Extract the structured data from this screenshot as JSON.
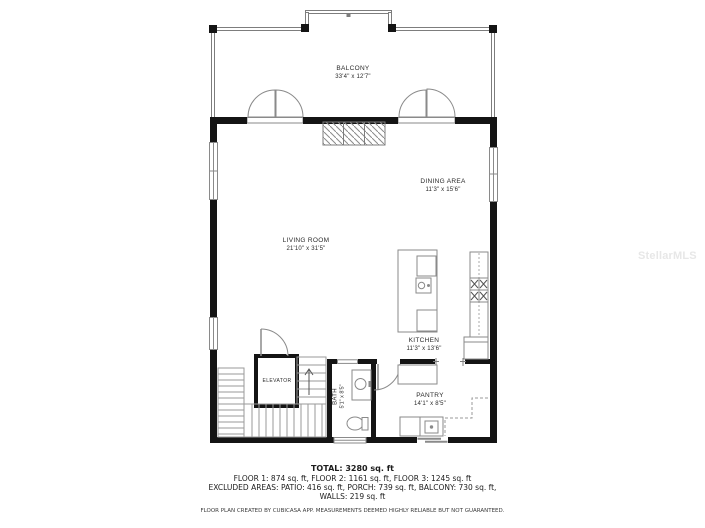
{
  "watermark": "StellarMLS",
  "rooms": {
    "balcony": {
      "name": "BALCONY",
      "dims": "33'4\" x 12'7\""
    },
    "living_room": {
      "name": "LIVING ROOM",
      "dims": "21'10\" x 31'5\""
    },
    "dining_area": {
      "name": "DINING AREA",
      "dims": "11'3\" x 15'6\""
    },
    "kitchen": {
      "name": "KITCHEN",
      "dims": "11'3\" x 13'6\""
    },
    "pantry": {
      "name": "PANTRY",
      "dims": "14'1\" x 8'5\""
    },
    "bath": {
      "name": "BATH",
      "dims": "5'1\" x 8'5\""
    },
    "elevator": {
      "name": "ELEVATOR"
    }
  },
  "summary": {
    "total": "TOTAL: 3280 sq. ft",
    "floors": "FLOOR 1: 874 sq. ft, FLOOR 2: 1161 sq. ft, FLOOR 3: 1245 sq. ft",
    "excluded": "EXCLUDED AREAS: PATIO: 416 sq. ft, PORCH: 739 sq. ft, BALCONY: 730 sq. ft,",
    "walls": "WALLS: 219 sq. ft",
    "disclaimer": "FLOOR PLAN CREATED BY CUBICASA APP. MEASUREMENTS DEEMED HIGHLY RELIABLE BUT NOT GUARANTEED."
  },
  "colors": {
    "wall": "#141414",
    "thin_line": "#8a8a8a",
    "stair_line": "#9a9a9a",
    "text": "#2a2a2a",
    "watermark": "#e7e7e7"
  }
}
